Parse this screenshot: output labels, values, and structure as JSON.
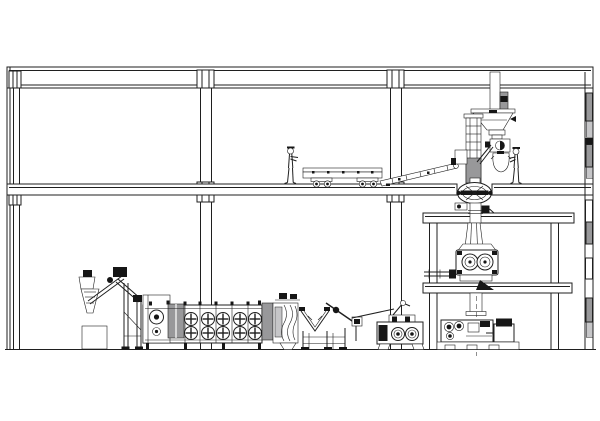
{
  "document": {
    "type": "technical-elevation-drawing",
    "subject": "Feed pellet plant building section elevation with process equipment",
    "background": "#ffffff"
  },
  "colors": {
    "line": "#1f1f1f",
    "solid_black": "#161616",
    "hatch_gray": "#98989a",
    "hatch_light": "#c6c6c8",
    "white": "#ffffff"
  },
  "structure": {
    "floors": [
      "roof-slab",
      "mezzanine-floor",
      "ground-floor"
    ],
    "columns": [
      "left-wall-column",
      "mid-column-a",
      "mid-column-b",
      "right-wall"
    ],
    "platforms": [
      "upper-service-platform",
      "lower-service-platform"
    ],
    "wall_window_blocks": 10
  },
  "equipment": [
    {
      "name": "feed-hopper-elevator",
      "zone": "ground-floor-left"
    },
    {
      "name": "belt-dryer",
      "zone": "ground-floor-left",
      "fan_columns": 5,
      "fan_rows": 2
    },
    {
      "name": "dryer-discharge-chute",
      "zone": "ground-floor-center"
    },
    {
      "name": "vibrating-screen",
      "zone": "ground-floor-center"
    },
    {
      "name": "twin-roll-machine",
      "zone": "ground-floor-center"
    },
    {
      "name": "flat-belt-conveyor",
      "zone": "mezzanine"
    },
    {
      "name": "inclined-conveyor",
      "zone": "mezzanine"
    },
    {
      "name": "roof-feed-pipe",
      "zone": "mezzanine-right"
    },
    {
      "name": "weigh-hopper",
      "zone": "mezzanine-right"
    },
    {
      "name": "rotary-valve",
      "zone": "mezzanine-right"
    },
    {
      "name": "bag-filler",
      "zone": "mezzanine-right"
    },
    {
      "name": "bucket-elevator-head",
      "zone": "mezzanine-right"
    },
    {
      "name": "rotary-distributor",
      "zone": "mezzanine-right"
    },
    {
      "name": "pellet-mill",
      "zone": "service-platform"
    },
    {
      "name": "crumbler",
      "zone": "ground-floor-right"
    },
    {
      "name": "drive-motor",
      "zone": "ground-floor-right"
    }
  ],
  "people": [
    {
      "name": "operator-on-mezzanine",
      "location": "beside flat conveyor"
    },
    {
      "name": "operator-at-bag-filler",
      "location": "beside bag filler"
    }
  ]
}
